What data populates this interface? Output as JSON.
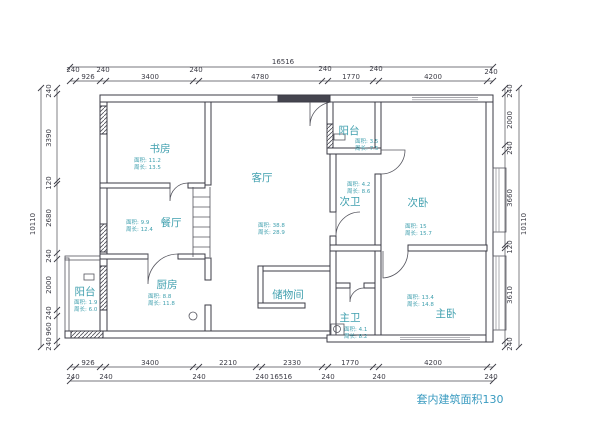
{
  "drawing": {
    "caption": "套内建筑面积130",
    "colors": {
      "room_label": "#3f9fae",
      "dimension_text": "#3c3c46",
      "caption_text": "#3a9bc0",
      "wall": "#3b3b45"
    },
    "rooms": {
      "study": {
        "name": "书房",
        "area": "面积: 11.2",
        "perimeter": "周长: 13.5"
      },
      "living": {
        "name": "客厅",
        "area": "面积: 38.8",
        "perimeter": "周长: 28.9"
      },
      "balcony_top": {
        "name": "阳台",
        "area": "面积: 3.5",
        "perimeter": "周长: 7.5"
      },
      "bath_second": {
        "name": "次卫",
        "area": "面积: 4.2",
        "perimeter": "周长: 8.6"
      },
      "bedroom_second": {
        "name": "次卧",
        "area": "面积: 15",
        "perimeter": "周长: 15.7"
      },
      "dining": {
        "name": "餐厅",
        "area": "面积: 9.9",
        "perimeter": "周长: 12.4"
      },
      "kitchen": {
        "name": "厨房",
        "area": "面积: 8.8",
        "perimeter": "周长: 11.8"
      },
      "balcony_left": {
        "name": "阳台",
        "area": "面积: 1.9",
        "perimeter": "周长: 6.0"
      },
      "storage": {
        "name": "储物间"
      },
      "bath_master": {
        "name": "主卫",
        "area": "面积: 4.1",
        "perimeter": "周长: 8.2"
      },
      "bedroom_master": {
        "name": "主卧",
        "area": "面积: 13.4",
        "perimeter": "周长: 14.8"
      }
    },
    "dimensions": {
      "top": {
        "total": "16516",
        "segments": [
          "240",
          "926",
          "240",
          "3400",
          "240",
          "4780",
          "240",
          "1770",
          "240",
          "4200",
          "240"
        ]
      },
      "bottom": {
        "total": "16516",
        "segments": [
          "240",
          "926",
          "240",
          "3400",
          "240",
          "2210",
          "240",
          "2330",
          "240",
          "1770",
          "240",
          "4200",
          "240"
        ]
      },
      "left": {
        "total": "10110",
        "segments": [
          "240",
          "3390",
          "120",
          "2680",
          "240",
          "2000",
          "240",
          "960",
          "240"
        ]
      },
      "right": {
        "total": "10110",
        "segments": [
          "240",
          "2000",
          "240",
          "3660",
          "120",
          "3610",
          "240"
        ]
      }
    }
  }
}
